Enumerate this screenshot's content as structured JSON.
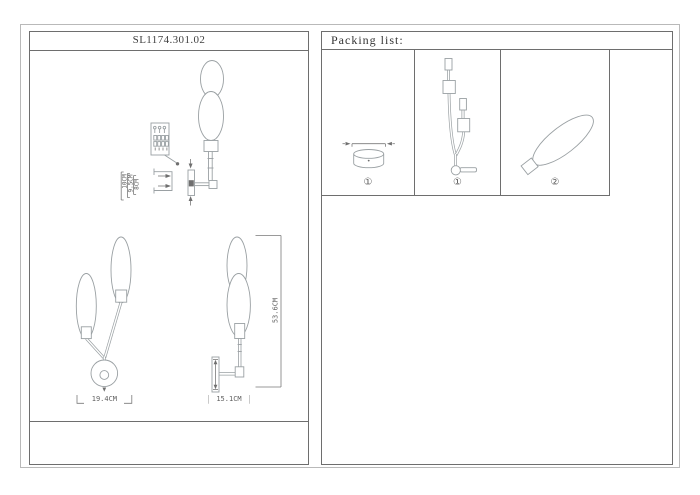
{
  "left_panel": {
    "title": "SL1174.301.02",
    "dimensions": {
      "d10": "10CM",
      "d9_5": "9.5CM",
      "d8": "8CM",
      "front_width": "19.4CM",
      "side_depth": "15.1CM",
      "total_height": "53.6CM"
    },
    "drawing_names": [
      "wall-lamp-mounting-detail",
      "wall-lamp-front-view",
      "wall-lamp-side-view"
    ]
  },
  "right_panel": {
    "header": "Packing list:",
    "items": [
      {
        "label": "①",
        "part": "canopy-base"
      },
      {
        "label": "①",
        "part": "lamp-frame"
      },
      {
        "label": "②",
        "part": "glass-shade"
      }
    ]
  },
  "colors": {
    "drawing_line": "#9aa0a3",
    "panel_border": "#6e6e6e",
    "outer_frame": "#b9b9b9",
    "text": "#3f3f3f"
  }
}
